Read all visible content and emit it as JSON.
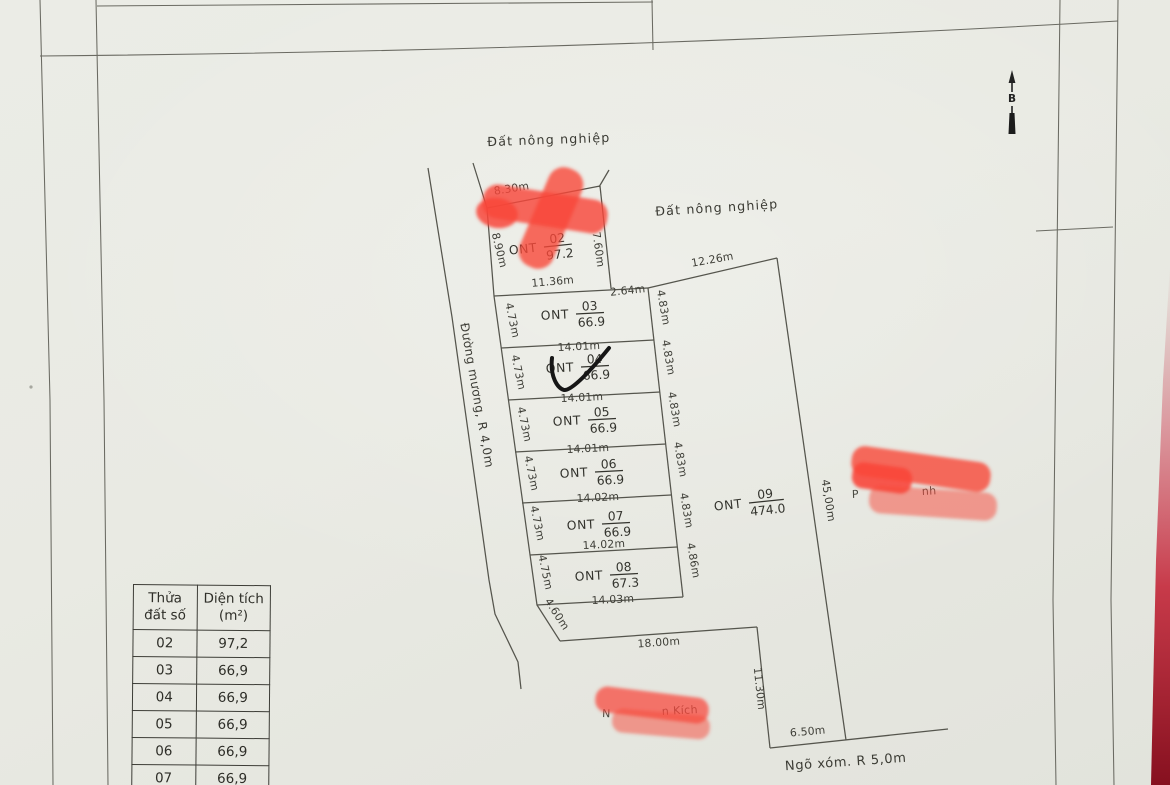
{
  "map": {
    "labels": {
      "agri_top": "Đất nông nghiệp",
      "agri_right": "Đất nông nghiệp",
      "canal_road": "Đường mương, R 4,0m",
      "alley_road": "Ngõ xóm. R 5,0m",
      "north": "B"
    },
    "plots": [
      {
        "code": "ONT",
        "number": "02",
        "area": "97.2"
      },
      {
        "code": "ONT",
        "number": "03",
        "area": "66.9"
      },
      {
        "code": "ONT",
        "number": "04",
        "area": "66.9"
      },
      {
        "code": "ONT",
        "number": "05",
        "area": "66.9"
      },
      {
        "code": "ONT",
        "number": "06",
        "area": "66.9"
      },
      {
        "code": "ONT",
        "number": "07",
        "area": "66.9"
      },
      {
        "code": "ONT",
        "number": "08",
        "area": "67.3"
      },
      {
        "code": "ONT",
        "number": "09",
        "area": "474.0"
      }
    ],
    "dimensions": {
      "d830": "8.30m",
      "d890": "8.90m",
      "d760": "7.60m",
      "d1136": "11.36m",
      "d264": "2.64m",
      "d1226": "12.26m",
      "w03": "14.01m",
      "w04": "14.01m",
      "w05": "14.01m",
      "w06": "14.02m",
      "w07": "14.02m",
      "w08": "14.03m",
      "l03": "4.73m",
      "l04": "4.73m",
      "l05": "4.73m",
      "l06": "4.73m",
      "l07": "4.73m",
      "l08": "4.75m",
      "l460": "4.60m",
      "r03": "4.83m",
      "r04": "4.83m",
      "r05": "4.83m",
      "r06": "4.83m",
      "r07": "4.83m",
      "r08": "4.86m",
      "d4500": "45,00m",
      "d1800": "18.00m",
      "d1130": "11.30m",
      "d650": "6.50m"
    },
    "redacted_fragments": {
      "right_start": "P",
      "right_end": "nh",
      "bottom_start": "N",
      "bottom_end": "n Kích"
    }
  },
  "table": {
    "headers": {
      "col1_line1": "Thửa",
      "col1_line2": "đất số",
      "col2_line1": "Diện tích",
      "col2_line2": "(m²)"
    },
    "rows": [
      {
        "plot": "02",
        "area": "97,2"
      },
      {
        "plot": "03",
        "area": "66,9"
      },
      {
        "plot": "04",
        "area": "66,9"
      },
      {
        "plot": "05",
        "area": "66,9"
      },
      {
        "plot": "06",
        "area": "66,9"
      },
      {
        "plot": "07",
        "area": "66,9"
      }
    ]
  },
  "colors": {
    "red_marker": "#f8473a",
    "edge_red": "#b0172a",
    "paper": "#e9eae3",
    "line": "#55554d"
  }
}
